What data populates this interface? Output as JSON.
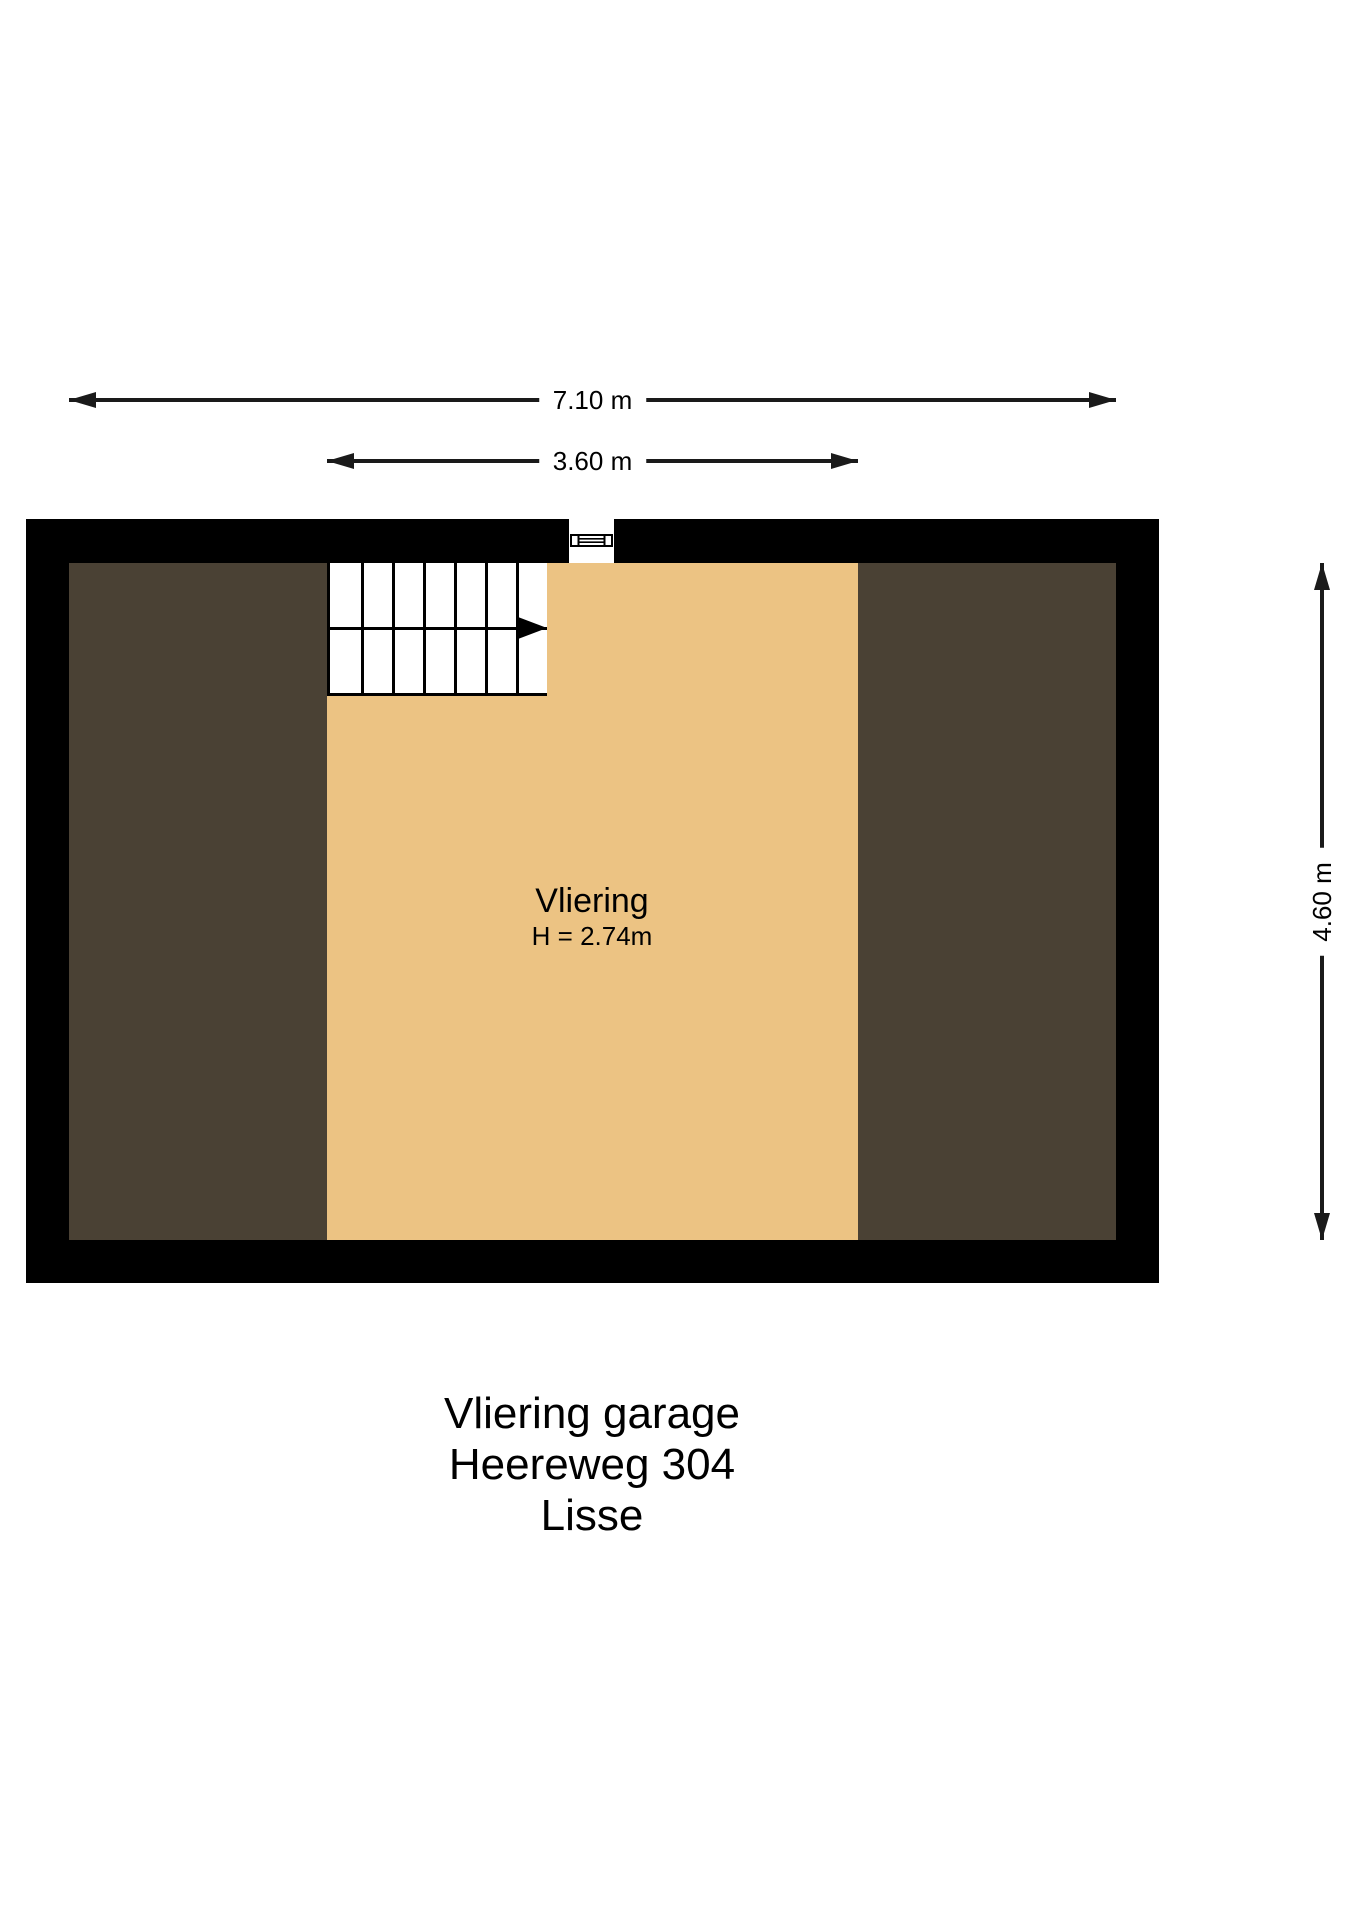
{
  "dimensions": {
    "total_width": "7.10 m",
    "room_width": "3.60 m",
    "total_height": "4.60 m"
  },
  "room_label": {
    "name": "Vliering",
    "height_note": "H = 2.74m"
  },
  "stairs": {
    "treads": 7,
    "direction": "right"
  },
  "title": {
    "lines": [
      "Vliering garage",
      "Heereweg 304",
      "Lisse"
    ]
  },
  "colors": {
    "wall": "#000000",
    "storage": "#4a4134",
    "floor": "#ecc383",
    "line": "#1a1a1a",
    "background": "#ffffff"
  }
}
